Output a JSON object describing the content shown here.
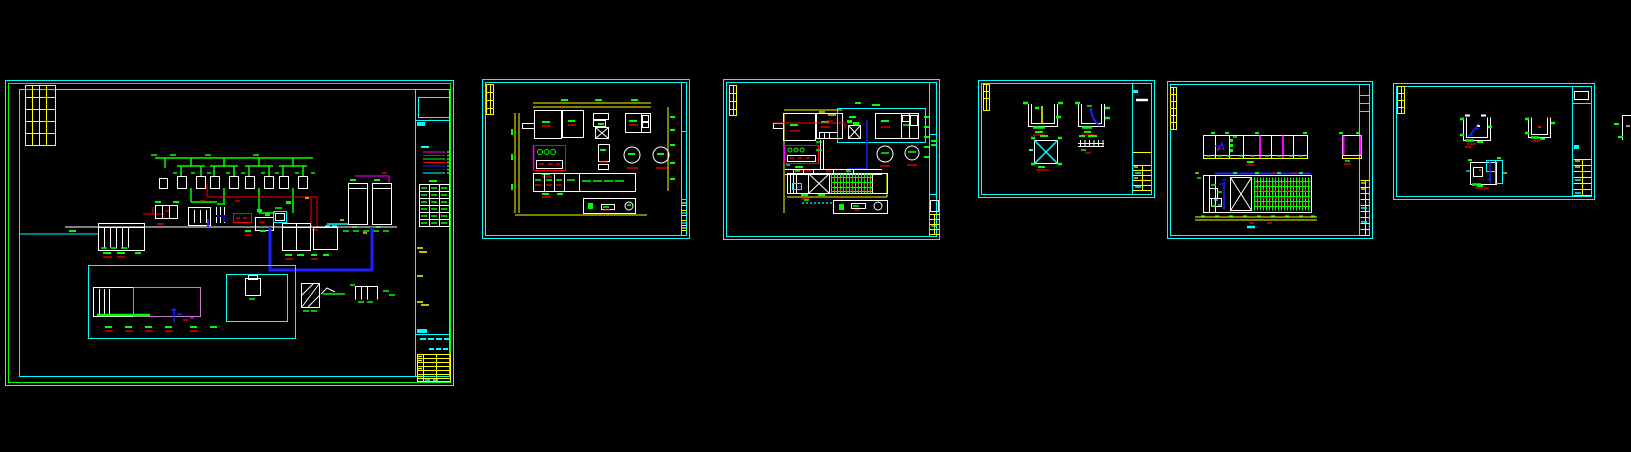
{
  "canvas": {
    "width": 1631,
    "height": 452,
    "background": "#000000",
    "description": "CAD model space with six drawing sheets of a water treatment plant design and one partially visible sheet at the right edge; all annotation text is sub-pixel CAD micro-text"
  },
  "palette": {
    "frame": "#00FFFF",
    "linework": "#FFFFFF",
    "labels": "#00FF00",
    "dimensions": "#FFFF00",
    "annotations": "#FF0000",
    "pipe_blue": "#1F1FFF",
    "pipe_dark_blue": "#0000B4",
    "magenta": "#FF00FF",
    "basin_outline": "#CC7ACC"
  },
  "sheets": [
    {
      "id": "sheet-1",
      "kind": "process-flow-diagram",
      "x": 5,
      "y": 80,
      "width": 449,
      "height": 306,
      "legend_line_colors": [
        "#FF00FF",
        "#FF0000",
        "#00FF00",
        "#FF0000",
        "#1F1FFF",
        "#0000B4",
        "#00FFFF"
      ],
      "equipment_table": {
        "columns": 3,
        "rows": 6
      },
      "mixer_clusters": 4,
      "clarifier_tanks": 2,
      "title_block": "right-edge column with legend, equipment table and yellow revision table"
    },
    {
      "id": "sheet-2",
      "kind": "plant-layout-plan",
      "x": 482,
      "y": 79,
      "width": 208,
      "height": 160,
      "clarifier_circles": 2,
      "pump_circles_in_red_room": 3,
      "title_block": "right-edge column with yellow rows"
    },
    {
      "id": "sheet-3",
      "kind": "piping-layout-plan",
      "x": 723,
      "y": 79,
      "width": 217,
      "height": 161,
      "clarifier_circles": 2,
      "aeration_grid_hatch": true,
      "title_block": "right-edge column with yellow rows"
    },
    {
      "id": "sheet-4",
      "kind": "equipment-detail-sheet",
      "x": 978,
      "y": 80,
      "width": 177,
      "height": 118,
      "details": 4,
      "title_block": "right-edge column with yellow rows"
    },
    {
      "id": "sheet-5",
      "kind": "longitudinal-sections",
      "x": 1167,
      "y": 81,
      "width": 206,
      "height": 158,
      "sections": 2,
      "aeration_grid_hatch": true,
      "title_block": "right-edge column with yellow rows"
    },
    {
      "id": "sheet-6",
      "kind": "tank-detail-sheet",
      "x": 1393,
      "y": 83,
      "width": 202,
      "height": 117,
      "details": 3,
      "title_block": "right-edge column with yellow rows"
    },
    {
      "id": "sheet-7",
      "kind": "partial-sheet-cut-off",
      "x": 1614,
      "y": 112,
      "width": 17,
      "height": 34
    }
  ]
}
